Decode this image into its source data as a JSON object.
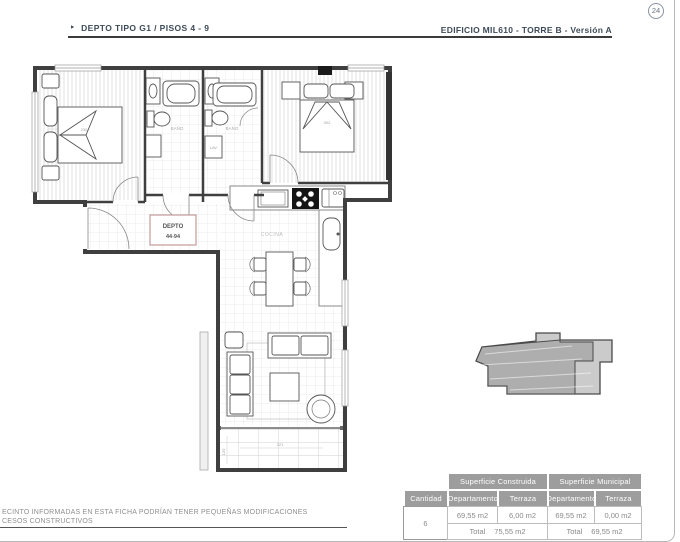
{
  "page": {
    "badge_number": "24"
  },
  "header": {
    "bullet": "‣",
    "left_title": "DEPTO TIPO G1 / PISOS 4 - 9",
    "right_title": "EDIFICIO MIL610 - TORRE B - Versión A"
  },
  "plan": {
    "unit_box": {
      "line1": "DEPTO",
      "line2": "44-94"
    },
    "labels": {
      "bath1": "BAÑO",
      "bath2": "BAÑO",
      "kitchen": "COCINA",
      "laundry": "LAV"
    },
    "dimensions": {
      "bed1_width": "230",
      "bed2_width": "302",
      "terrace_width": "321",
      "terrace_depth": "120"
    }
  },
  "summary_table": {
    "group_construida": "Superficie Construida",
    "group_municipal": "Superficie Municipal",
    "col_cantidad": "Cantidad",
    "col_departamento_1": "Departamento",
    "col_terraza_1": "Terraza",
    "col_departamento_2": "Departamento",
    "col_terraza_2": "Terraza",
    "cantidad_value": "6",
    "construida_departamento": "69,55 m2",
    "construida_terraza": "6,00 m2",
    "municipal_departamento": "69,55 m2",
    "municipal_terraza": "0,00 m2",
    "total_label_construida": "Total",
    "total_label_municipal": "Total",
    "construida_total": "75,55 m2",
    "municipal_total": "69,55 m2"
  },
  "footer": {
    "line1": "ECINTO INFORMADAS EN ESTA FICHA PODRÍAN TENER PEQUEÑAS MODIFICACIONES",
    "line2": "CESOS CONSTRUCTIVOS"
  },
  "colors": {
    "accent_text": "#3d4b58",
    "plan_line": "#3f3f3f",
    "table_header_bg": "#9d9d9d",
    "unit_box_border": "#c49b9b"
  }
}
